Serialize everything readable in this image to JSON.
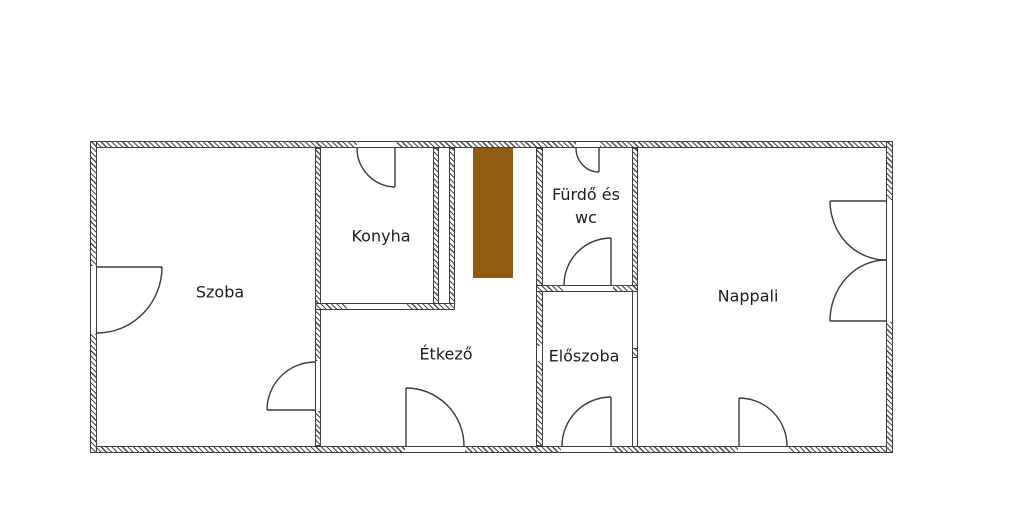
{
  "floorplan": {
    "rooms": [
      {
        "id": "szoba",
        "label": "Szoba"
      },
      {
        "id": "konyha",
        "label": "Konyha"
      },
      {
        "id": "furdo-wc",
        "label": "Fürdő és\nwc"
      },
      {
        "id": "etkezo",
        "label": "Étkező"
      },
      {
        "id": "eloszoba",
        "label": "Előszoba"
      },
      {
        "id": "nappali",
        "label": "Nappali"
      }
    ],
    "colors": {
      "chimney": "#8f5c12",
      "wall_line": "#3f3f3f",
      "label_text": "#1c1c1c",
      "background": "#ffffff"
    }
  }
}
